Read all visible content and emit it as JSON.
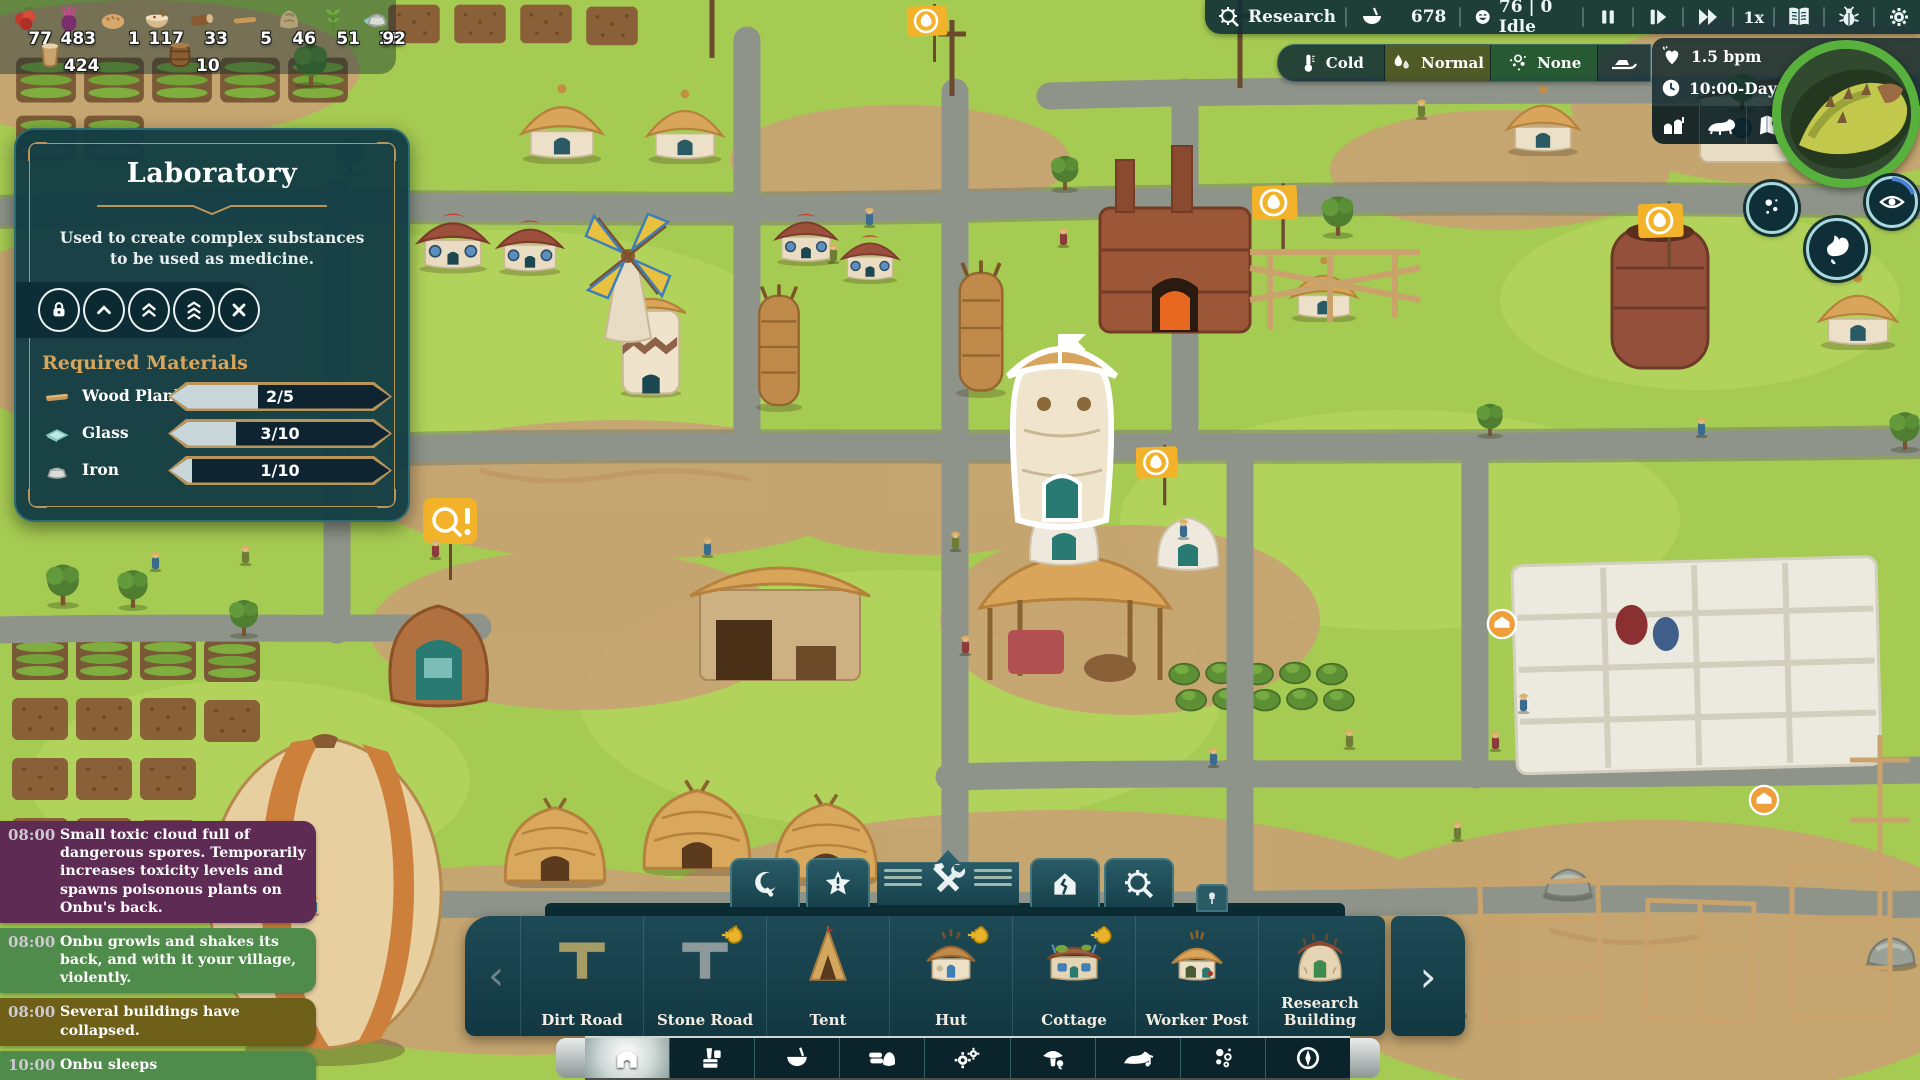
{
  "resources": {
    "row1": [
      {
        "icon": "berries-icon",
        "value": "77"
      },
      {
        "icon": "beetroot-icon",
        "value": "483"
      },
      {
        "icon": "bread-icon",
        "value": "1"
      },
      {
        "icon": "porridge-icon",
        "value": "117"
      },
      {
        "icon": "wood-log-icon",
        "value": "33"
      },
      {
        "icon": "stick-icon",
        "value": "5"
      },
      {
        "icon": "stone-icon",
        "value": "46"
      },
      {
        "icon": "herb-icon",
        "value": "51"
      },
      {
        "icon": "glass-icon",
        "value": "18"
      },
      {
        "icon": "iron-icon",
        "value": "92"
      }
    ],
    "row2": [
      {
        "icon": "clay-pot-icon",
        "value": "424"
      },
      {
        "icon": "barrel-icon",
        "value": "10"
      }
    ]
  },
  "topbar": {
    "research_label": "Research",
    "food_value": "678",
    "villagers_value": "76 | 0 Idle",
    "speed_label": "1x"
  },
  "weather": {
    "temperature": "Cold",
    "humidity": "Normal",
    "spores": "None"
  },
  "onbu": {
    "heartbeat": "1.5 bpm",
    "datetime": "10:00-Day 18"
  },
  "tooltip": {
    "title": "Laboratory",
    "description": "Used to create complex substances to be used as medicine.",
    "materials_heading": "Required Materials",
    "materials": [
      {
        "icon": "wood-plank-icon",
        "name": "Wood Plank",
        "progress": "2/5",
        "fill_pct": 40
      },
      {
        "icon": "glass-icon",
        "name": "Glass",
        "progress": "3/10",
        "fill_pct": 30
      },
      {
        "icon": "iron-icon",
        "name": "Iron",
        "progress": "1/10",
        "fill_pct": 10
      }
    ]
  },
  "event_log": [
    {
      "time": "08:00",
      "text": "Small toxic cloud full of dangerous spores. Temporarily increases toxicity levels and spawns poisonous plants on Onbu's back.",
      "color": "#5e2b55"
    },
    {
      "time": "08:00",
      "text": "Onbu growls and shakes its back, and with it your village, violently.",
      "color": "#4f8b4a"
    },
    {
      "time": "08:00",
      "text": "Several buildings have collapsed.",
      "color": "#6e6018"
    },
    {
      "time": "10:00",
      "text": "Onbu sleeps",
      "color": "#4f8b4a"
    }
  ],
  "build_menu": {
    "tabs": [
      "harvest",
      "priority",
      "construction",
      "demolish",
      "research"
    ],
    "active_tab": "construction",
    "items": [
      {
        "label": "Dirt Road",
        "cost_badge": false
      },
      {
        "label": "Stone Road",
        "cost_badge": true
      },
      {
        "label": "Tent",
        "cost_badge": false
      },
      {
        "label": "Hut",
        "cost_badge": true
      },
      {
        "label": "Cottage",
        "cost_badge": true
      },
      {
        "label": "Worker Post",
        "cost_badge": false
      },
      {
        "label": "Research Building",
        "cost_badge": false
      }
    ],
    "categories": [
      "housing",
      "storage",
      "food",
      "resources",
      "production",
      "farming",
      "onbu",
      "spores",
      "expedition"
    ],
    "active_category": "housing"
  },
  "colors": {
    "ui_teal": "#16414b",
    "gold": "#c9a05c",
    "flag_yellow": "#f2b32b",
    "event_toxic": "#5e2b55",
    "event_onbu": "#4f8b4a",
    "event_damage": "#6e6018"
  }
}
